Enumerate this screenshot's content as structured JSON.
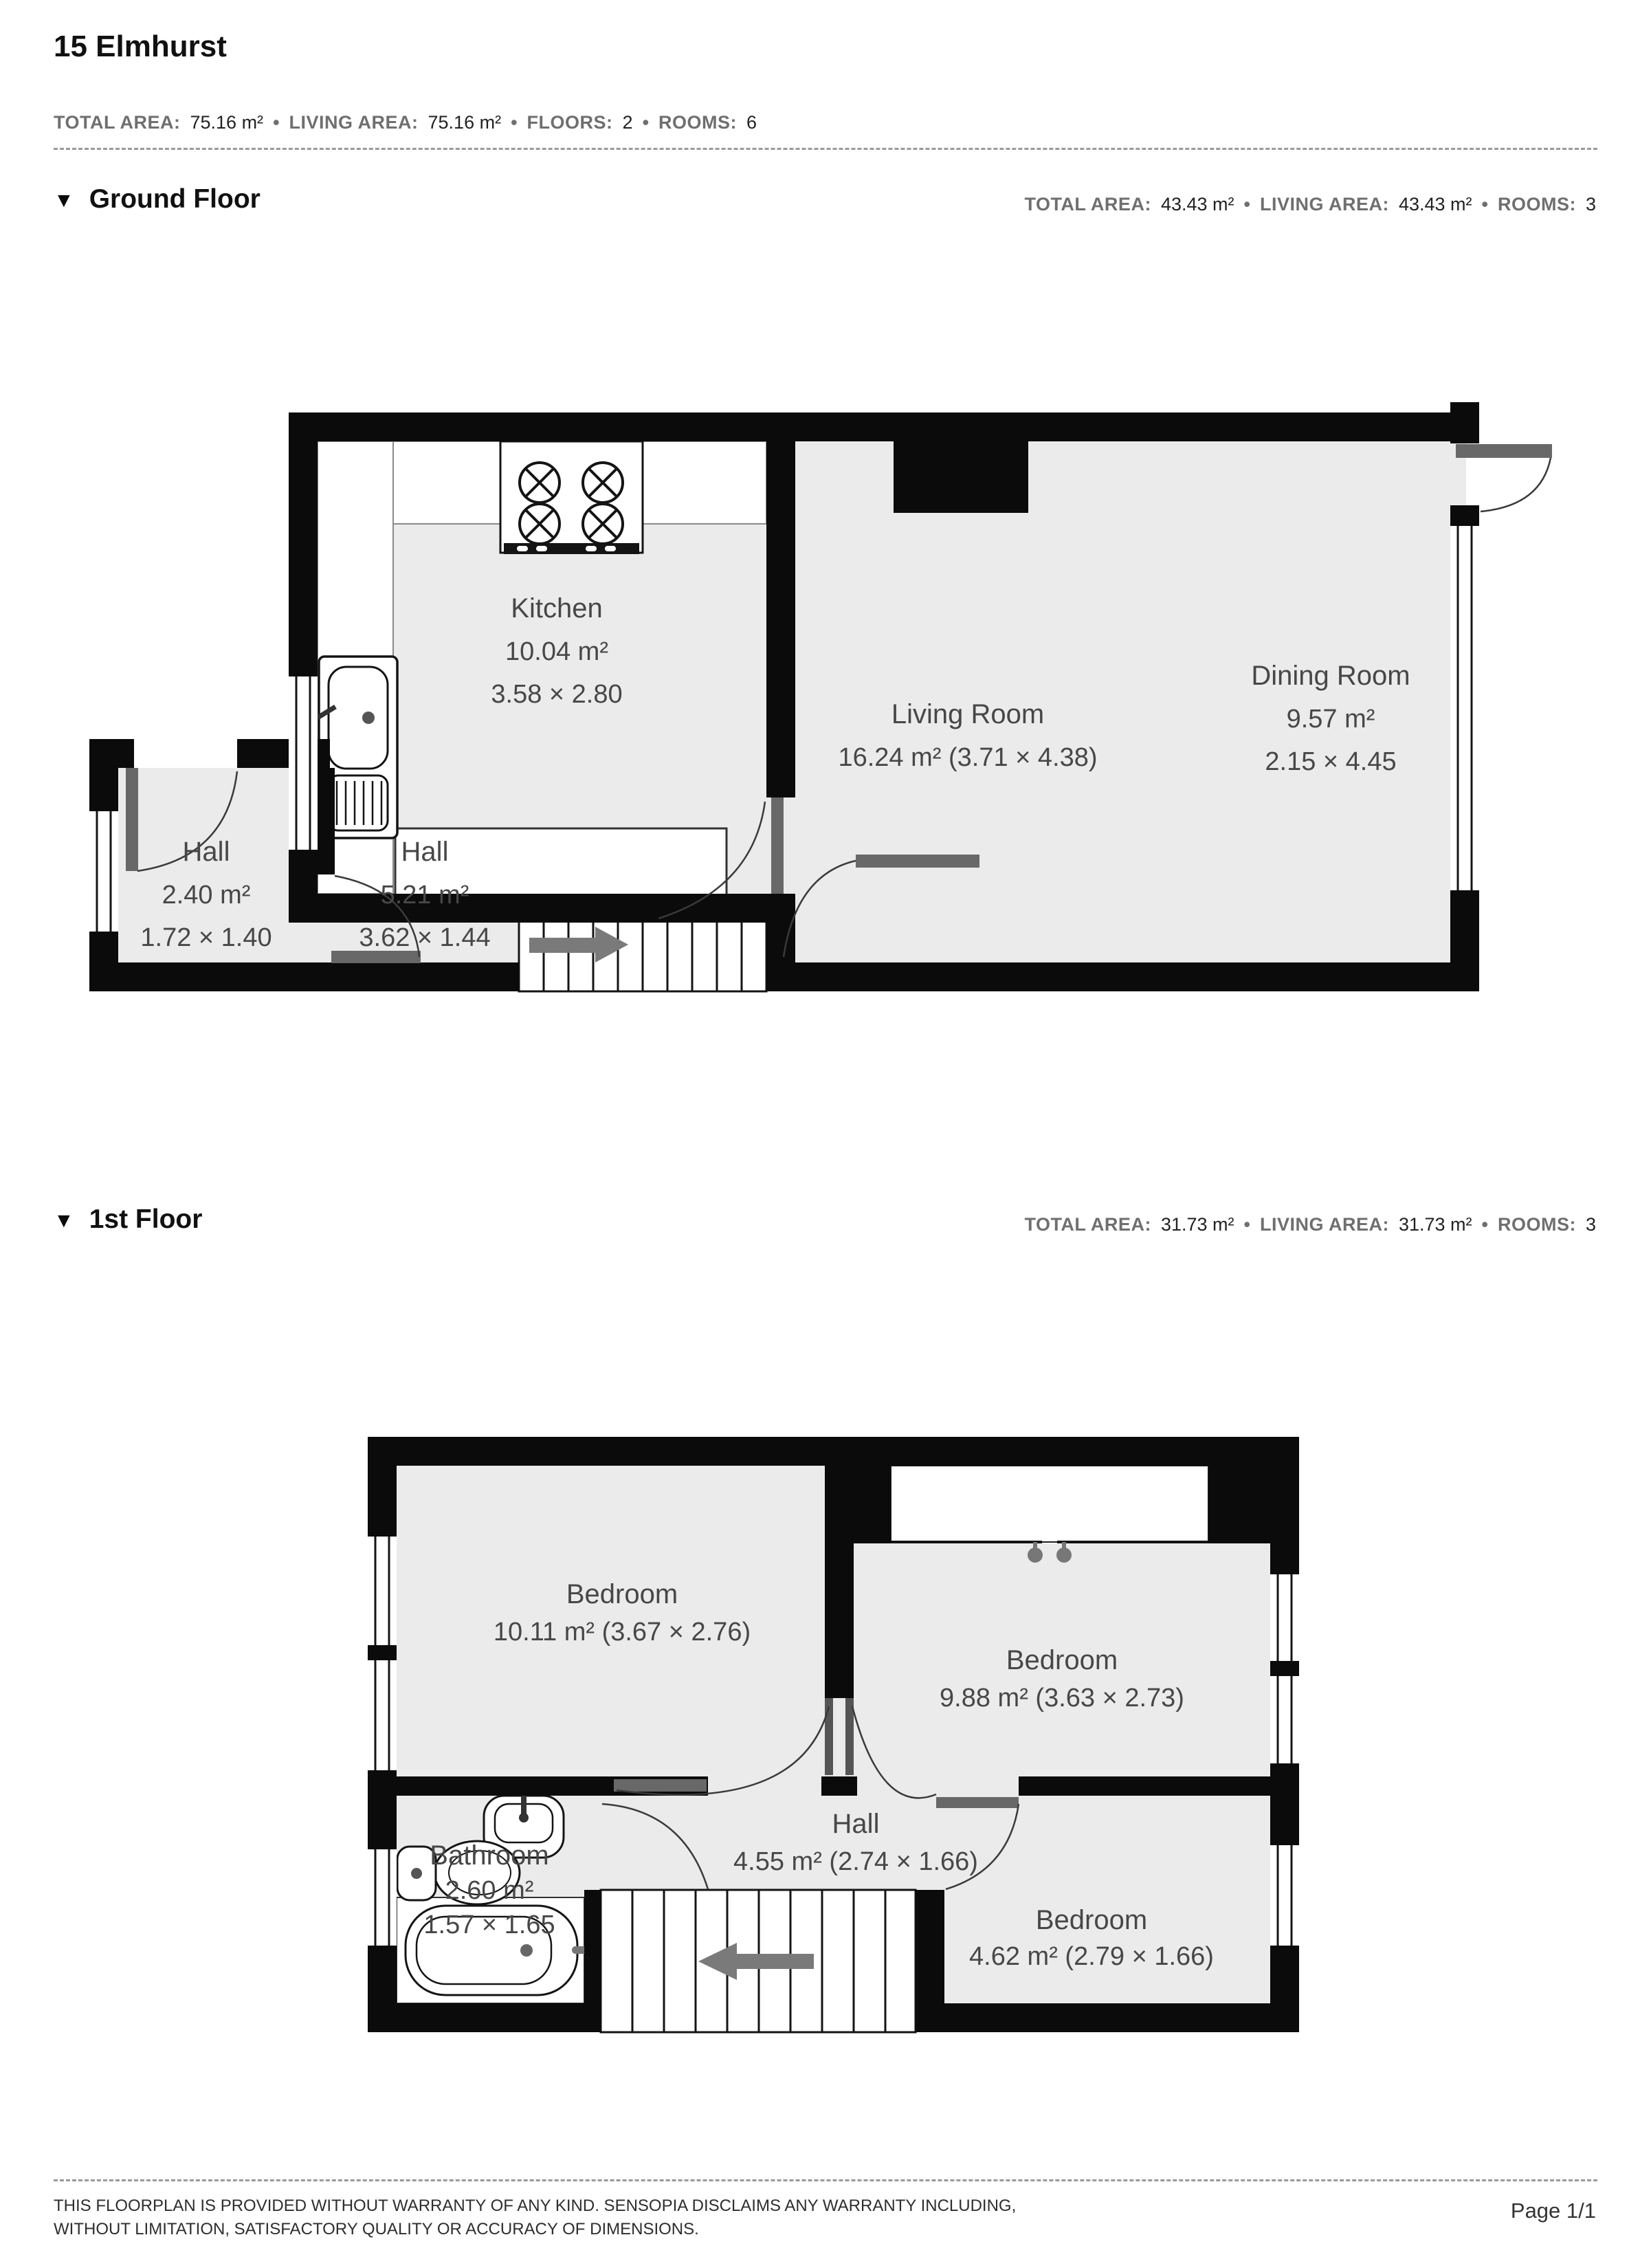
{
  "header": {
    "title": "15 Elmhurst",
    "separator": "•",
    "stats": [
      {
        "label": "TOTAL AREA:",
        "value": "75.16 m²"
      },
      {
        "label": "LIVING AREA:",
        "value": "75.16 m²"
      },
      {
        "label": "FLOORS:",
        "value": "2"
      },
      {
        "label": "ROOMS:",
        "value": "6"
      }
    ]
  },
  "floors": [
    {
      "marker": "▼",
      "name": "Ground Floor",
      "stats": [
        {
          "label": "TOTAL AREA:",
          "value": "43.43 m²"
        },
        {
          "label": "LIVING AREA:",
          "value": "43.43 m²"
        },
        {
          "label": "ROOMS:",
          "value": "3"
        }
      ],
      "rooms": {
        "kitchen": {
          "name": "Kitchen",
          "area": "10.04 m²",
          "dims": "3.58 × 2.80"
        },
        "living": {
          "name": "Living Room",
          "area_dims": "16.24 m² (3.71 × 4.38)"
        },
        "dining": {
          "name": "Dining Room",
          "area": "9.57 m²",
          "dims": "2.15 × 4.45"
        },
        "hall_small": {
          "name": "Hall",
          "area": "2.40 m²",
          "dims": "1.72 × 1.40"
        },
        "hall_large": {
          "name": "Hall",
          "area": "5.21 m²",
          "dims": "3.62 × 1.44"
        }
      }
    },
    {
      "marker": "▼",
      "name": "1st Floor",
      "stats": [
        {
          "label": "TOTAL AREA:",
          "value": "31.73 m²"
        },
        {
          "label": "LIVING AREA:",
          "value": "31.73 m²"
        },
        {
          "label": "ROOMS:",
          "value": "3"
        }
      ],
      "rooms": {
        "bedroom_left": {
          "name": "Bedroom",
          "area_dims": "10.11 m² (3.67 × 2.76)"
        },
        "bedroom_right": {
          "name": "Bedroom",
          "area_dims": "9.88 m² (3.63 × 2.73)"
        },
        "hall": {
          "name": "Hall",
          "area_dims": "4.55 m² (2.74 × 1.66)"
        },
        "bathroom": {
          "name": "Bathroom",
          "area": "2.60 m²",
          "dims": "1.57 × 1.65"
        },
        "bedroom_small": {
          "name": "Bedroom",
          "area_dims": "4.62 m² (2.79 × 1.66)"
        }
      }
    }
  ],
  "footer": {
    "disclaimer_line1": "THIS FLOORPLAN IS PROVIDED WITHOUT WARRANTY OF ANY KIND. SENSOPIA DISCLAIMS ANY WARRANTY INCLUDING,",
    "disclaimer_line2": "WITHOUT LIMITATION, SATISFACTORY QUALITY OR ACCURACY OF DIMENSIONS.",
    "page_label": "Page 1/1"
  },
  "colors": {
    "wall": "#0b0b0b",
    "room_fill": "#ebebeb",
    "door_leaf": "#686868",
    "arc_stroke": "#3a3a3a",
    "label_text": "#474747",
    "muted_text": "#6f6f6f"
  }
}
